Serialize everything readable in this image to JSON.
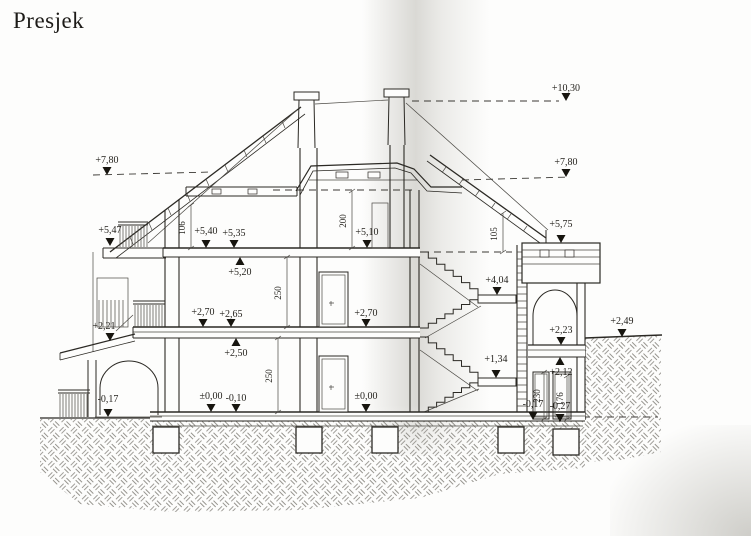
{
  "title": "Presjek",
  "colors": {
    "ink": "#2b2924",
    "hatch": "#96948e",
    "scan_shadow": "#b4b2ab",
    "paper": "#fdfdfc"
  },
  "levels": [
    {
      "text": "+10,30"
    },
    {
      "text": "+7,80"
    },
    {
      "text": "+7,80"
    },
    {
      "text": "+5,47"
    },
    {
      "text": "+5,75"
    },
    {
      "text": "+5,40"
    },
    {
      "text": "+5,35"
    },
    {
      "text": "+5,10"
    },
    {
      "text": "+5,20"
    },
    {
      "text": "+4,04"
    },
    {
      "text": "+2,70"
    },
    {
      "text": "+2,65"
    },
    {
      "text": "+2,70"
    },
    {
      "text": "+2,50"
    },
    {
      "text": "+2,21"
    },
    {
      "text": "+2,23"
    },
    {
      "text": "+2,12"
    },
    {
      "text": "+2,49"
    },
    {
      "text": "+1,34"
    },
    {
      "text": "±0,00"
    },
    {
      "text": "-0,10"
    },
    {
      "text": "±0,00"
    },
    {
      "text": "-0,17"
    },
    {
      "text": "-0,17"
    },
    {
      "text": "-0,27"
    }
  ],
  "dimensions": [
    {
      "text": "106"
    },
    {
      "text": "200"
    },
    {
      "text": "250"
    },
    {
      "text": "250"
    },
    {
      "text": "105"
    },
    {
      "text": "230"
    },
    {
      "text": "176"
    }
  ]
}
